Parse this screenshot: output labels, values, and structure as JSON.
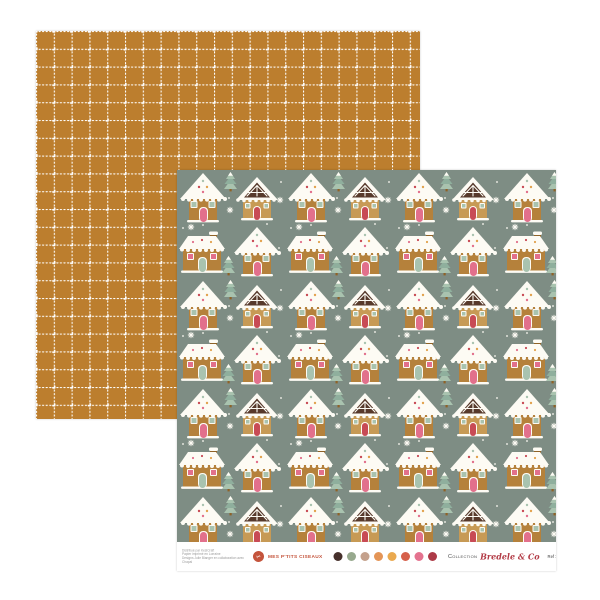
{
  "colors": {
    "paper_back": "#BC7E2E",
    "grid_dot": "#FFFFFF",
    "sage": "#7E8D84",
    "brown": "#B5813B",
    "brown_dark": "#8F6226",
    "caramel": "#C79A55",
    "icing": "#FDFBF4",
    "pink": "#E2708C",
    "red": "#C84B55",
    "mint": "#A9C3AF",
    "mint_dark": "#8FAF9D",
    "choc": "#57392B",
    "amber": "#E2A24E",
    "brand": "#C4543C",
    "script": "#B23A45"
  },
  "front_sheet": {
    "footer": {
      "distributor_lines": [
        "Distribué par KesiCraft",
        "Papier imprimé en Lorraine",
        "Designs Julie Blanger en collaboration avec Chapal"
      ],
      "logo_glyph": "✂",
      "brand": "MES P'TITS CISEAUX",
      "swatches": [
        "#46302B",
        "#97A98E",
        "#C4A18C",
        "#E49557",
        "#EAA94F",
        "#D6604A",
        "#E4738F",
        "#AD3A47"
      ],
      "collection_label": "Collection",
      "collection_name": "Bredele & Co",
      "ref_label": "Ref : PO-BCO403"
    }
  }
}
